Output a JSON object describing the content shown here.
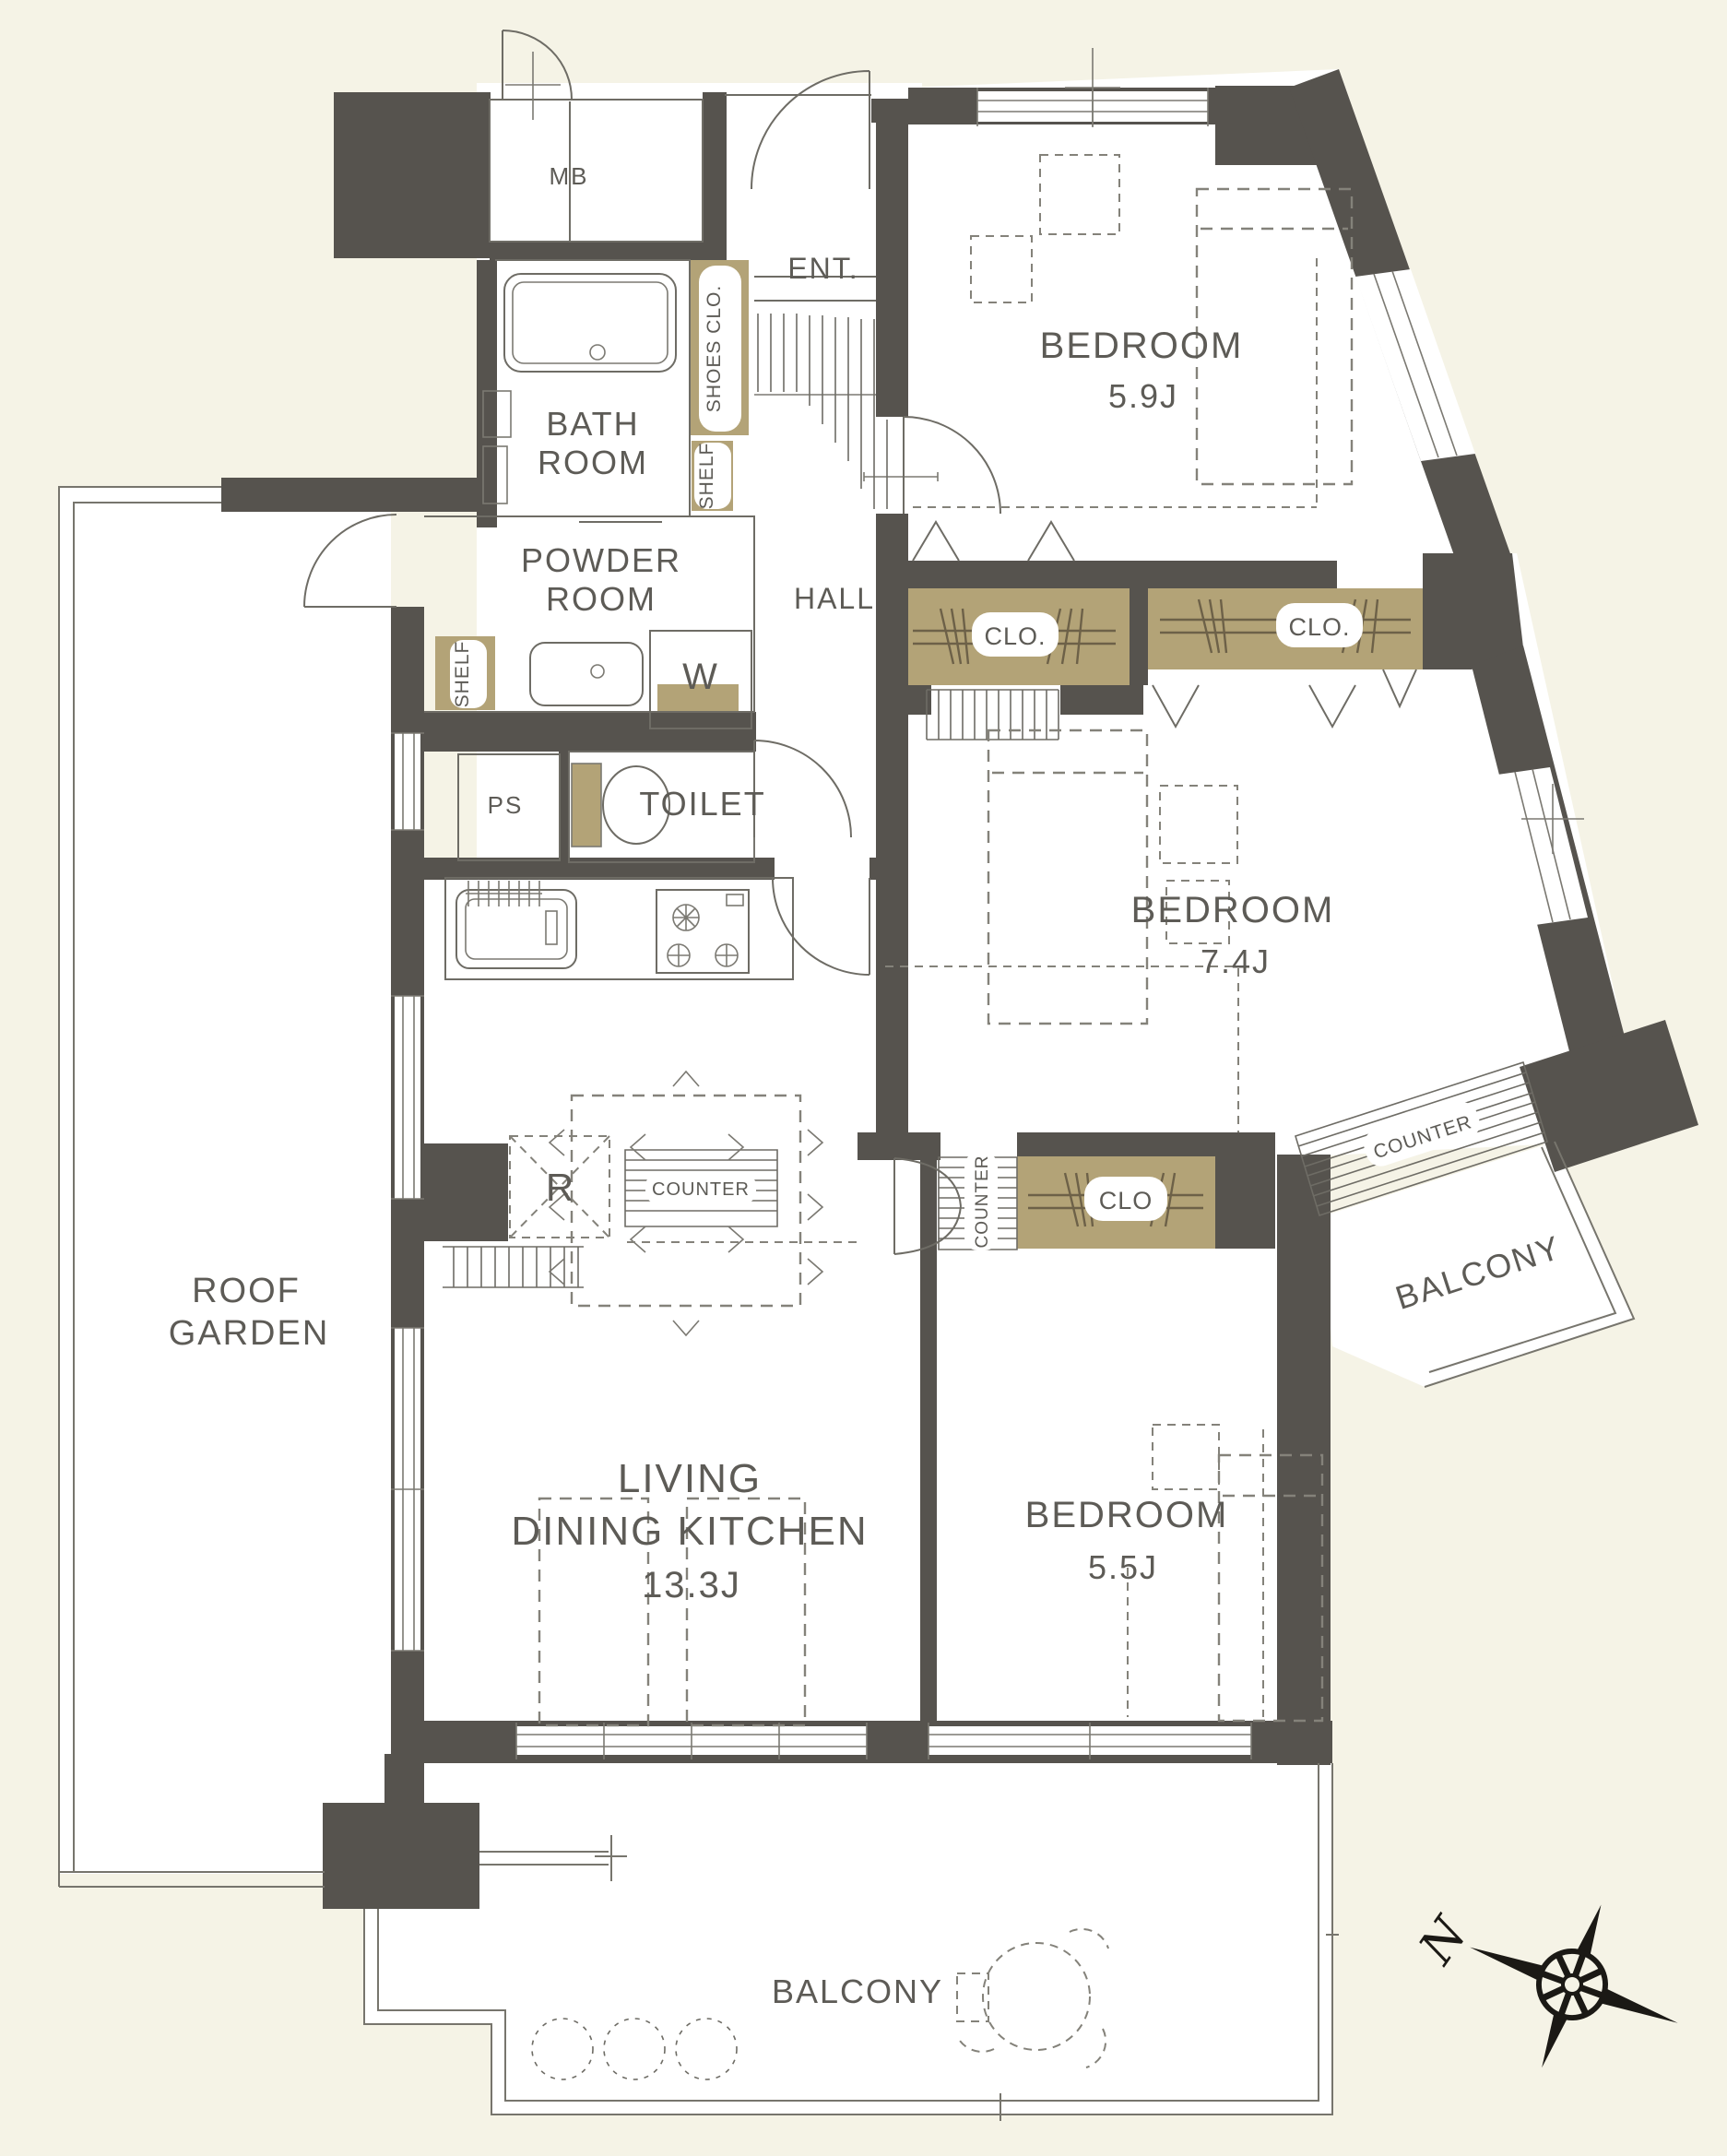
{
  "colors": {
    "background": "#f5f3e6",
    "wall": "#56534e",
    "closet_fill": "#b3a377",
    "line": "#6e6c65",
    "text": "#5d5b56",
    "compass": "#1b1915"
  },
  "rooms": {
    "bedroom_1": {
      "label": "BEDROOM",
      "size": "5.9J"
    },
    "bedroom_2": {
      "label": "BEDROOM",
      "size": "7.4J"
    },
    "bedroom_3": {
      "label": "BEDROOM",
      "size": "5.5J"
    },
    "ldk": {
      "line1": "LIVING",
      "line2": "DINING KITCHEN",
      "size": "13.3J"
    },
    "bath": {
      "line1": "BATH",
      "line2": "ROOM"
    },
    "powder_room": {
      "line1": "POWDER",
      "line2": "ROOM"
    },
    "toilet": {
      "label": "TOILET"
    },
    "hall": {
      "label": "HALL"
    },
    "entrance": {
      "label": "ENT."
    },
    "roof_garden": {
      "line1": "ROOF",
      "line2": "GARDEN"
    },
    "balcony_south": {
      "label": "BALCONY"
    },
    "balcony_east": {
      "label": "BALCONY"
    }
  },
  "storage": {
    "shoes_closet": "SHOES CLO.",
    "shelf_upper": "SHELF",
    "shelf_lower": "SHELF",
    "closet_1": "CLO.",
    "closet_2": "CLO.",
    "closet_3": "CLO"
  },
  "equipment": {
    "meter_box": "MB",
    "pipe_space": "PS",
    "washing_machine": "W",
    "refrigerator": "R",
    "counter_kitchen": "COUNTER",
    "counter_bedroom3": "COUNTER",
    "counter_east": "COUNTER"
  },
  "compass": {
    "north": "N"
  }
}
